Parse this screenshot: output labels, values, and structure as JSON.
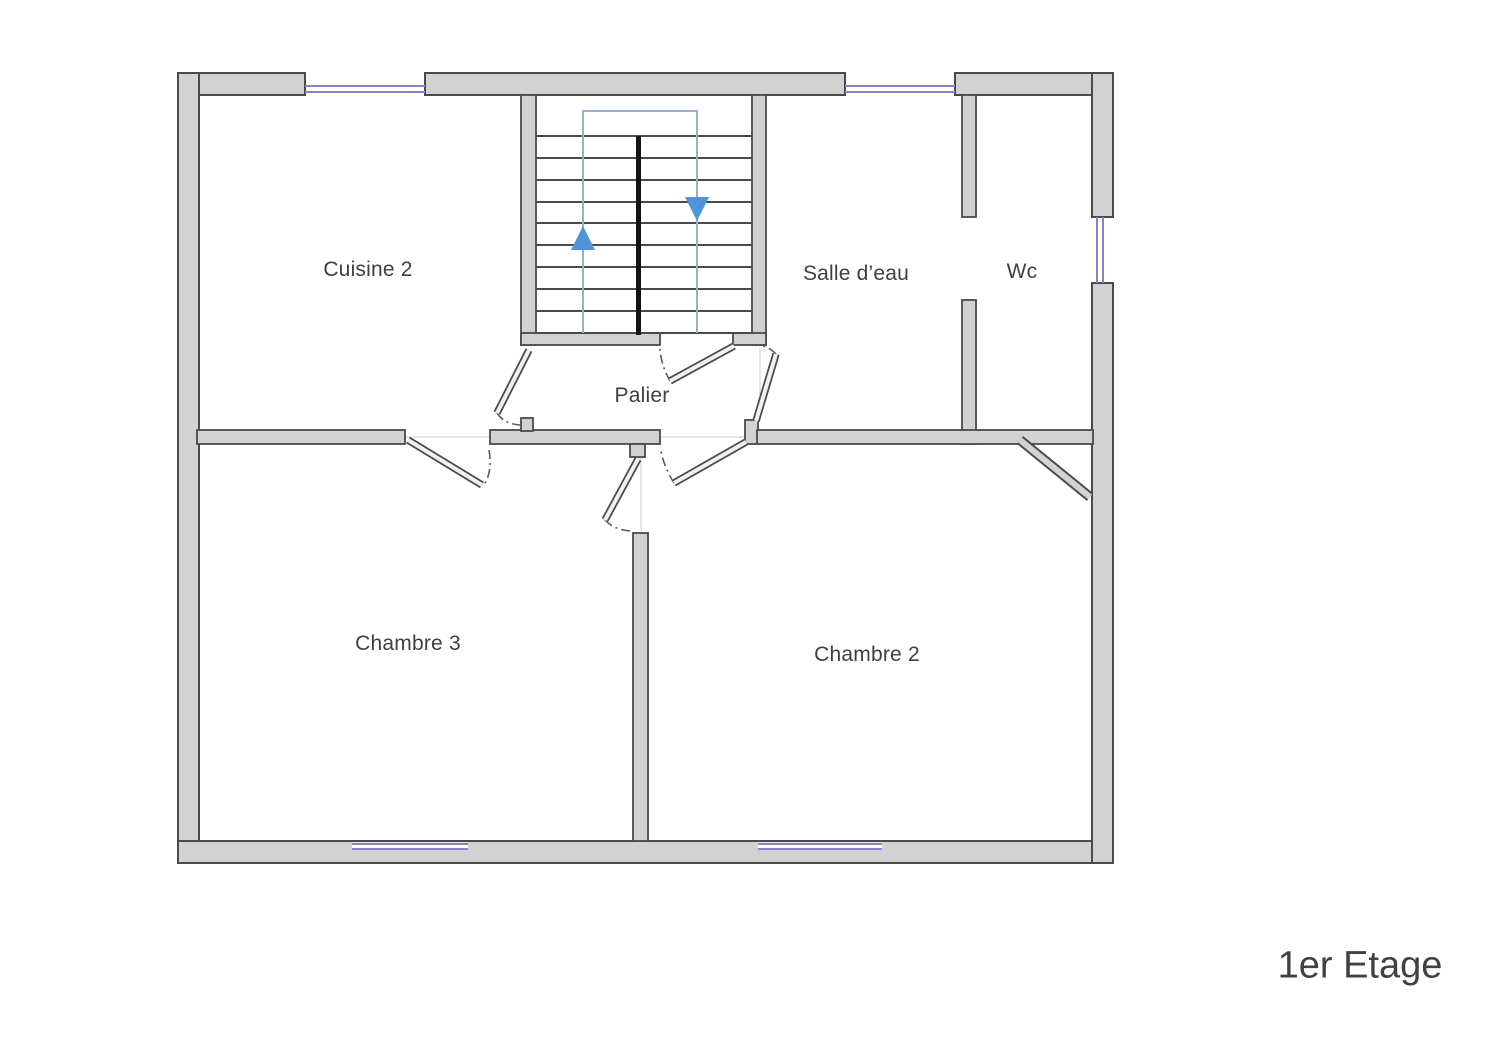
{
  "plan": {
    "floor_label": "1er Etage",
    "labels": {
      "cuisine2": "Cuisine 2",
      "salle_eau": "Salle d’eau",
      "wc": "Wc",
      "palier": "Palier",
      "chambre3": "Chambre 3",
      "chambre2": "Chambre 2"
    },
    "stairs": {
      "tread_count": 10,
      "arrows": [
        "up",
        "down"
      ]
    },
    "colors": {
      "wall_fill": "#d2d2d2",
      "wall_edge": "#4a4a4a",
      "window": "#8a82c6",
      "stair_arrow": "#4f93d8",
      "stair_path": "#96afd2",
      "text": "#3f3f3f"
    }
  }
}
